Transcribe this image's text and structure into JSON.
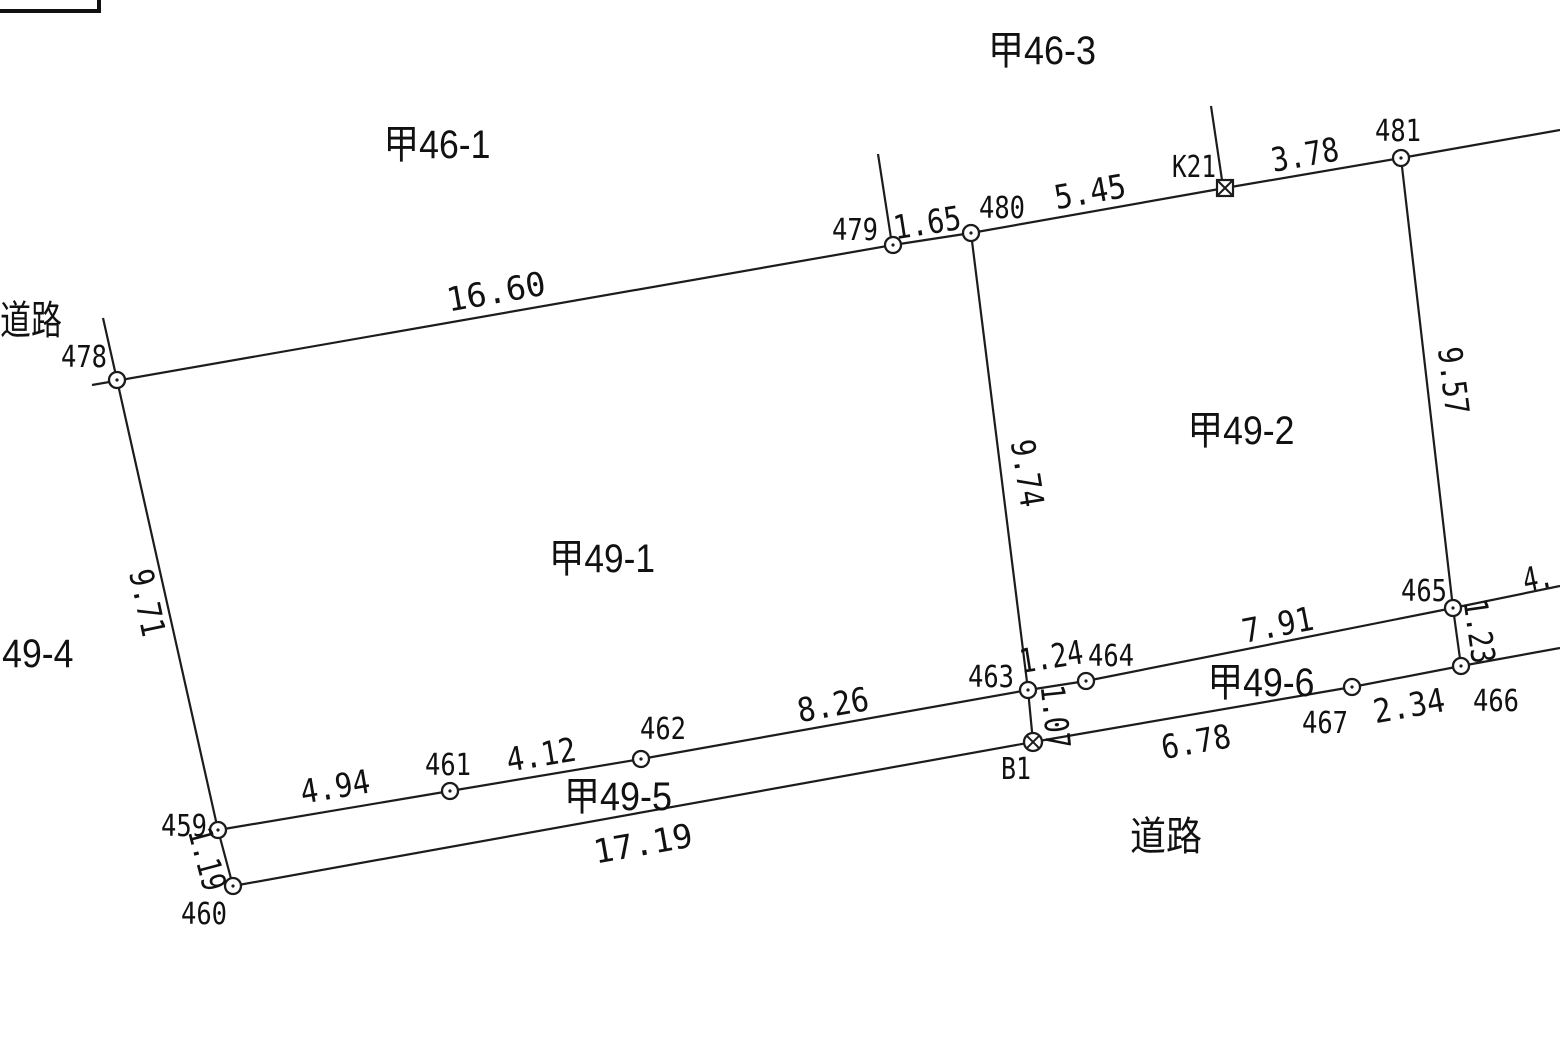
{
  "parcels": {
    "k46_1": "甲46-1",
    "k46_3": "甲46-3",
    "k49_1": "甲49-1",
    "k49_2": "甲49-2",
    "k49_4": "甲49-4",
    "k49_5": "甲49-5",
    "k49_6": "甲49-6",
    "road_left": "道路",
    "road_bottom": "道路"
  },
  "points": {
    "p459": "459",
    "p460": "460",
    "p461": "461",
    "p462": "462",
    "p463": "463",
    "p464": "464",
    "p465": "465",
    "p466": "466",
    "p467": "467",
    "p478": "478",
    "p479": "479",
    "p480": "480",
    "p481": "481",
    "k21": "K21",
    "b1": "B1"
  },
  "distances": {
    "d478_479": "16.60",
    "d479_480": "1.65",
    "d480_k21": "5.45",
    "dk21_481": "3.78",
    "d478_459": "9.71",
    "d459_460": "1.19",
    "d480_463": "9.74",
    "d481_465": "9.57",
    "d459_461": "4.94",
    "d461_462": "4.12",
    "d462_463": "8.26",
    "d463_464": "1.24",
    "d464_465": "7.91",
    "d465_edge": "4.",
    "d463_b1": "1.07",
    "d465_466": "1.23",
    "d460_b1": "17.19",
    "db1_467": "6.78",
    "d467_466": "2.34"
  }
}
